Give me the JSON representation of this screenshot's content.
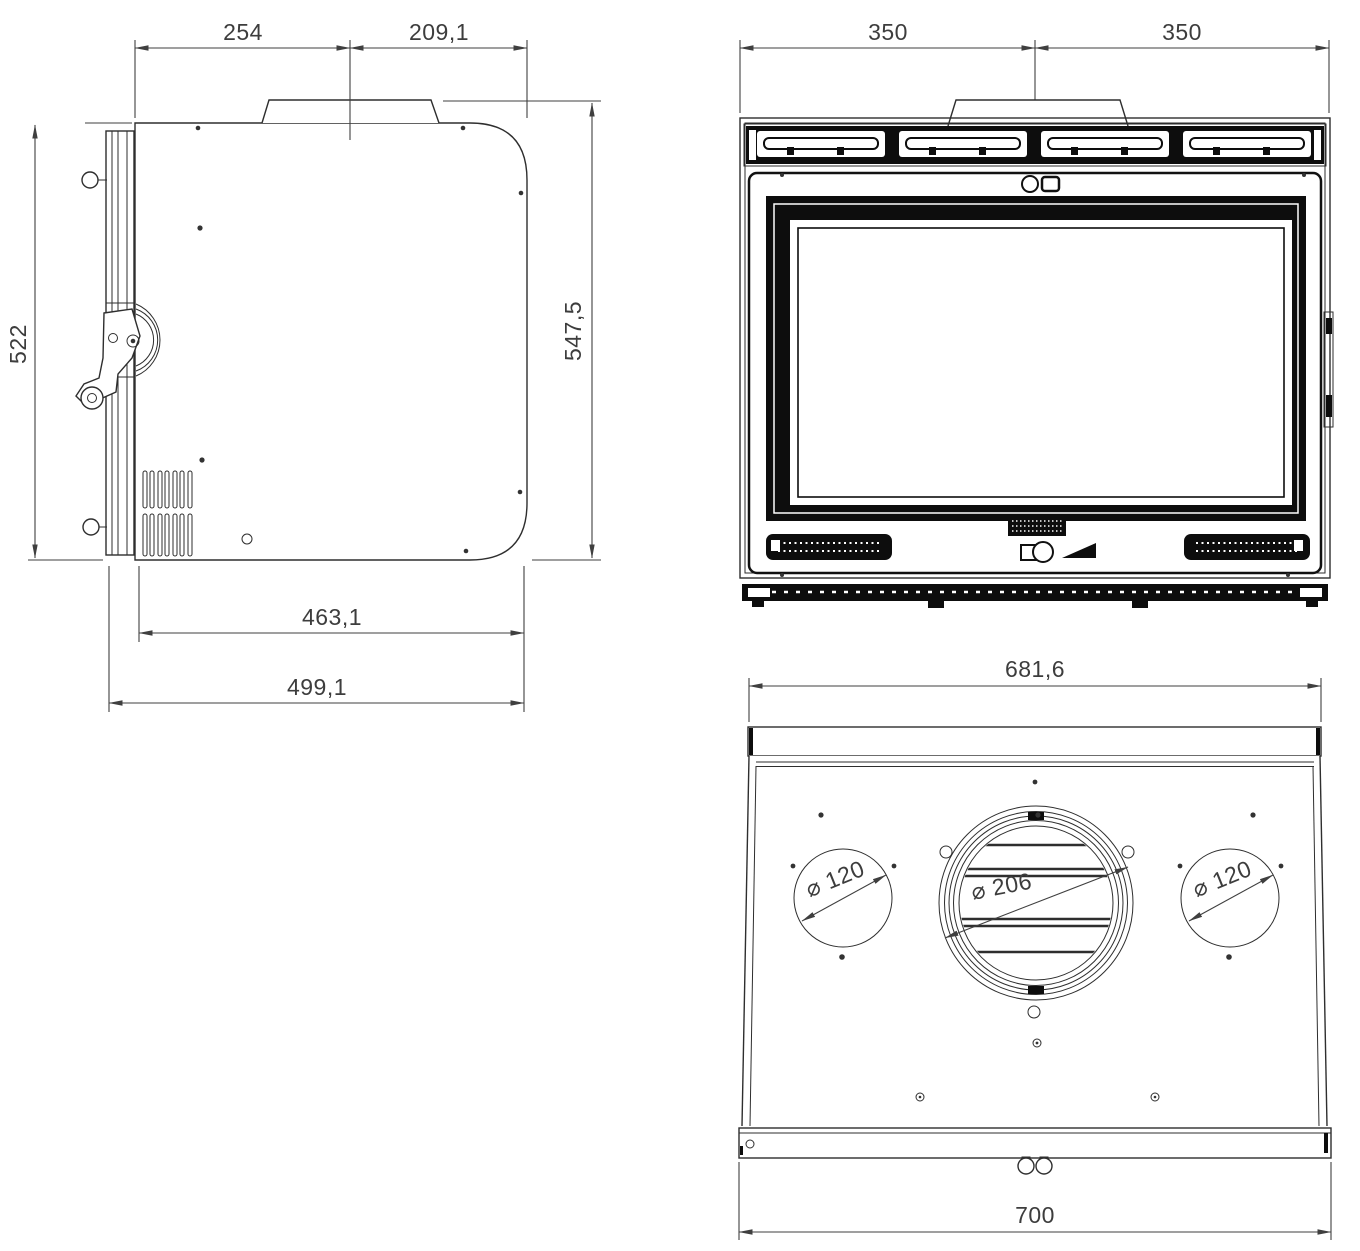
{
  "side_view": {
    "dims": {
      "top_front": "254",
      "top_rear": "209,1",
      "height_body": "522",
      "height_total": "547,5",
      "depth_inner": "463,1",
      "depth_total": "499,1"
    }
  },
  "front_view": {
    "dims": {
      "width_left": "350",
      "width_right": "350"
    }
  },
  "top_view": {
    "dims": {
      "width_rear": "681,6",
      "width_front": "700",
      "duct_left": "⌀ 120",
      "duct_center": "⌀ 206",
      "duct_right": "⌀ 120"
    }
  },
  "colors": {
    "line": "#2e2e2e",
    "dimension": "#3d3d3d",
    "solid_black": "#0d0d0d",
    "background": "#ffffff"
  }
}
